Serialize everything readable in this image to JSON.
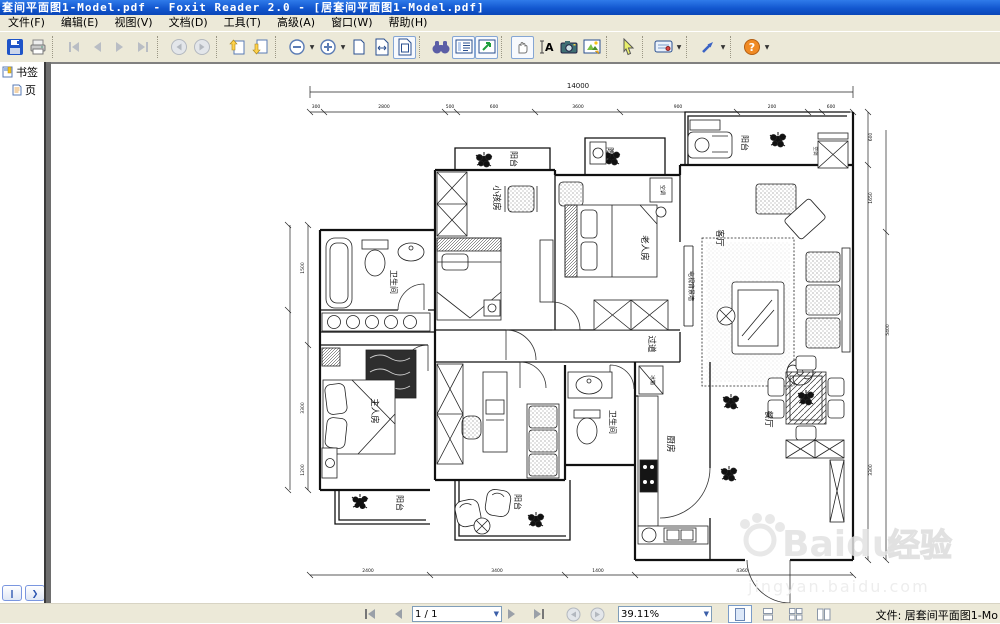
{
  "window": {
    "title": "套间平面图1-Model.pdf - Foxit Reader 2.0 - [居套间平面图1-Model.pdf]"
  },
  "menu": {
    "items": [
      "文件(F)",
      "编辑(E)",
      "视图(V)",
      "文档(D)",
      "工具(T)",
      "高级(A)",
      "窗口(W)",
      "帮助(H)"
    ]
  },
  "sidebar": {
    "bookmarks_label": "书签",
    "pages_label": "页"
  },
  "statusbar": {
    "page_field": "1 / 1",
    "zoom_field": "39.11%",
    "file_label": "文件: 居套间平面图1-Mo"
  },
  "plan": {
    "labels": {
      "balcony": "阳台",
      "kids_room": "小孩房",
      "elder_room": "老人房",
      "living_room": "客厅",
      "tv_wall": "电视背景墙",
      "hallway": "过道",
      "bathroom": "卫生间",
      "master_room": "主人房",
      "dining_room": "餐厅",
      "kitchen": "厨房",
      "fridge": "冰箱",
      "ac": "空调"
    },
    "dims": {
      "total_top": "14000",
      "top": [
        "300",
        "2800",
        "500",
        "600",
        "3600",
        "900",
        "200",
        "600"
      ],
      "bottom": [
        "2400",
        "3400",
        "1400",
        "4360"
      ],
      "left": [
        "1500",
        "3300",
        "1200"
      ],
      "right": [
        "600",
        "1650",
        "5400",
        "3300"
      ]
    }
  },
  "watermark": {
    "brand": "Baidu",
    "badge": "经验",
    "url": "jingyan.baidu.com"
  }
}
